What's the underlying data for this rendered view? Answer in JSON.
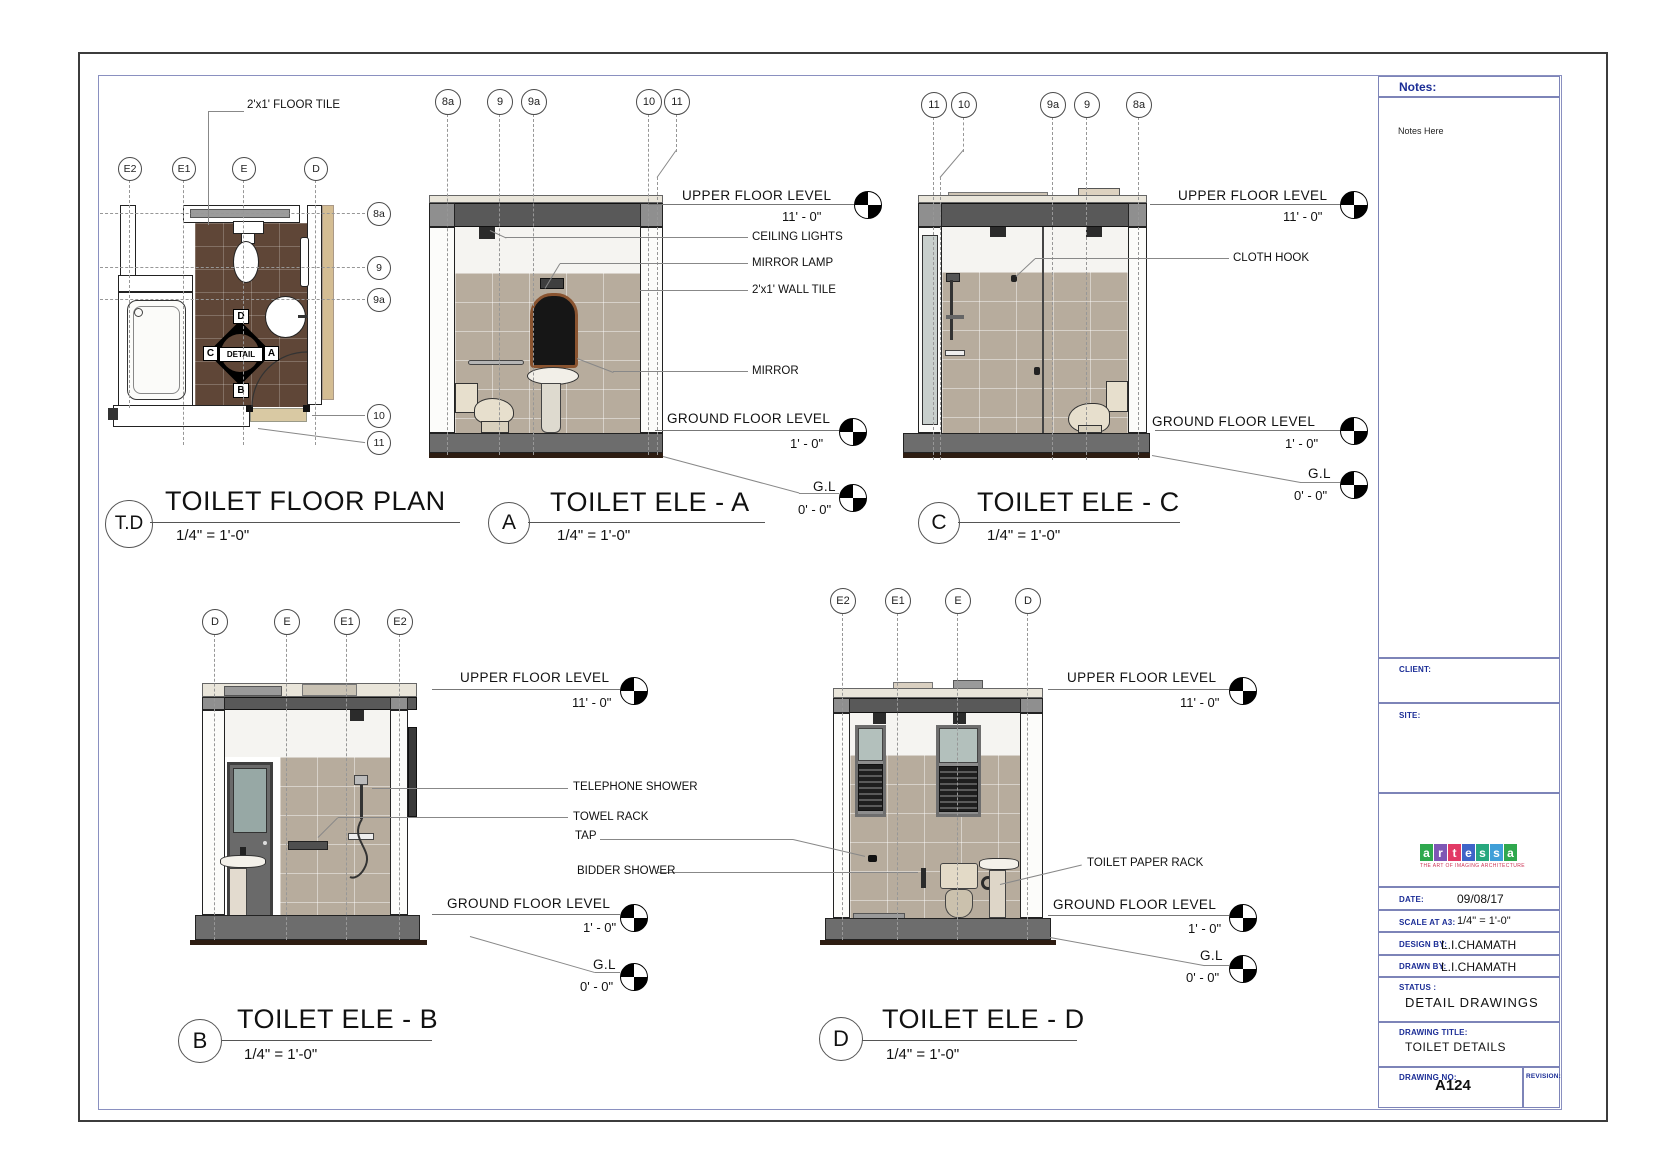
{
  "sheet": {
    "background": "#ffffff",
    "accent_blue": "#1b2d96",
    "border_color": "#8a90c0"
  },
  "levels": {
    "upper_label": "UPPER FLOOR LEVEL",
    "upper_value": "11' - 0\"",
    "ground_label": "GROUND FLOOR LEVEL",
    "ground_value": "1' - 0\"",
    "gl_label": "G.L",
    "gl_value": "0' - 0\""
  },
  "views": {
    "plan": {
      "ref": "T.D",
      "title": "TOILET FLOOR PLAN",
      "scale": "1/4\" = 1'-0\"",
      "grid_top": [
        "E2",
        "E1",
        "E",
        "D"
      ],
      "grid_right": [
        "8a",
        "9",
        "9a",
        "10",
        "11"
      ],
      "floor_tile_note": "2'x1' FLOOR TILE",
      "detail_marker": {
        "label": "DETAIL",
        "top": "D",
        "right": "A",
        "bottom": "B",
        "left": "C"
      }
    },
    "ele_a": {
      "ref": "A",
      "title": "TOILET ELE - A",
      "scale": "1/4\" = 1'-0\"",
      "grid": [
        "8a",
        "9",
        "9a",
        "10",
        "11"
      ],
      "annotations": {
        "ceiling_lights": "CEILING LIGHTS",
        "mirror_lamp": "MIRROR LAMP",
        "wall_tile": "2'x1' WALL TILE",
        "mirror": "MIRROR"
      }
    },
    "ele_c": {
      "ref": "C",
      "title": "TOILET ELE - C",
      "scale": "1/4\" = 1'-0\"",
      "grid": [
        "11",
        "10",
        "9a",
        "9",
        "8a"
      ],
      "annotations": {
        "cloth_hook": "CLOTH HOOK"
      }
    },
    "ele_b": {
      "ref": "B",
      "title": "TOILET ELE - B",
      "scale": "1/4\" = 1'-0\"",
      "grid": [
        "D",
        "E",
        "E1",
        "E2"
      ],
      "annotations": {
        "telephone_shower": "TELEPHONE SHOWER",
        "towel_rack": "TOWEL RACK",
        "tap": "TAP",
        "bidder_shower": "BIDDER SHOWER"
      }
    },
    "ele_d": {
      "ref": "D",
      "title": "TOILET ELE - D",
      "scale": "1/4\" = 1'-0\"",
      "grid": [
        "E2",
        "E1",
        "E",
        "D"
      ],
      "annotations": {
        "toilet_paper_rack": "TOILET PAPER RACK"
      }
    }
  },
  "title_block": {
    "notes_header": "Notes:",
    "notes_placeholder": "Notes Here",
    "client_label": "CLIENT:",
    "site_label": "SITE:",
    "logo": {
      "letters": [
        "a",
        "r",
        "t",
        "e",
        "s",
        "s",
        "a"
      ],
      "colors": [
        "#2fa84e",
        "#7e57b5",
        "#e23a66",
        "#3f64c8",
        "#27a87e",
        "#3f9fd8",
        "#2fa84e"
      ],
      "tagline": "THE ART OF IMAGING ARCHITECTURE"
    },
    "date_label": "DATE:",
    "date_value": "09/08/17",
    "scale_label": "SCALE AT A3:",
    "scale_value": "1/4\" = 1'-0\"",
    "design_label": "DESIGN BY:",
    "design_value": "L.I.CHAMATH",
    "drawn_label": "DRAWN BY:",
    "drawn_value": "L.I.CHAMATH",
    "status_label": "STATUS :",
    "status_value": "DETAIL DRAWINGS",
    "drawing_title_label": "DRAWING TITLE:",
    "drawing_title_value": "TOILET DETAILS",
    "drawing_no_label": "DRAWING NO:",
    "drawing_no_value": "A124",
    "revision_label": "REVISION:"
  }
}
